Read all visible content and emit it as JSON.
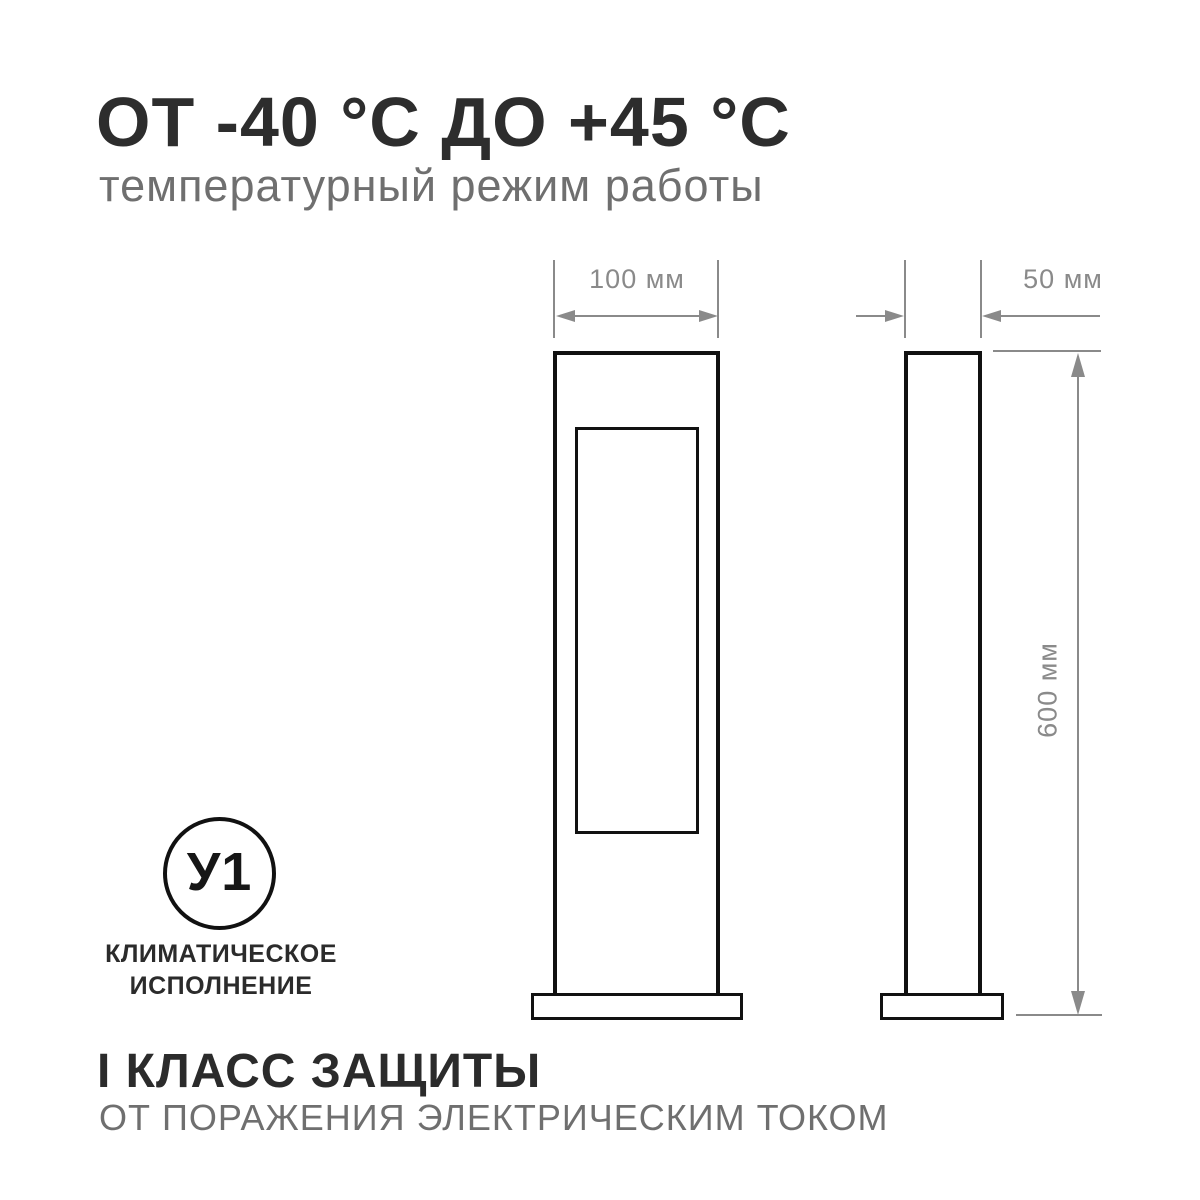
{
  "header": {
    "title": "ОТ -40 °С ДО +45 °С",
    "subtitle": "температурный режим работы"
  },
  "drawing": {
    "front_view": {
      "width_label": "100 мм"
    },
    "side_view": {
      "width_label": "50 мм"
    },
    "height_label": "600 мм"
  },
  "climate": {
    "badge_code": "У1",
    "label_line1": "КЛИМАТИЧЕСКОЕ",
    "label_line2": "ИСПОЛНЕНИЕ"
  },
  "protection": {
    "title": "I КЛАСС ЗАЩИТЫ",
    "subtitle": "ОТ ПОРАЖЕНИЯ ЭЛЕКТРИЧЕСКИМ ТОКОМ"
  },
  "colors": {
    "background": "#ffffff",
    "drawing_ink": "#111111",
    "dimension_gray": "#8a8a8a",
    "title_dark": "#2d2d2d",
    "text_gray": "#6f6f6f"
  }
}
